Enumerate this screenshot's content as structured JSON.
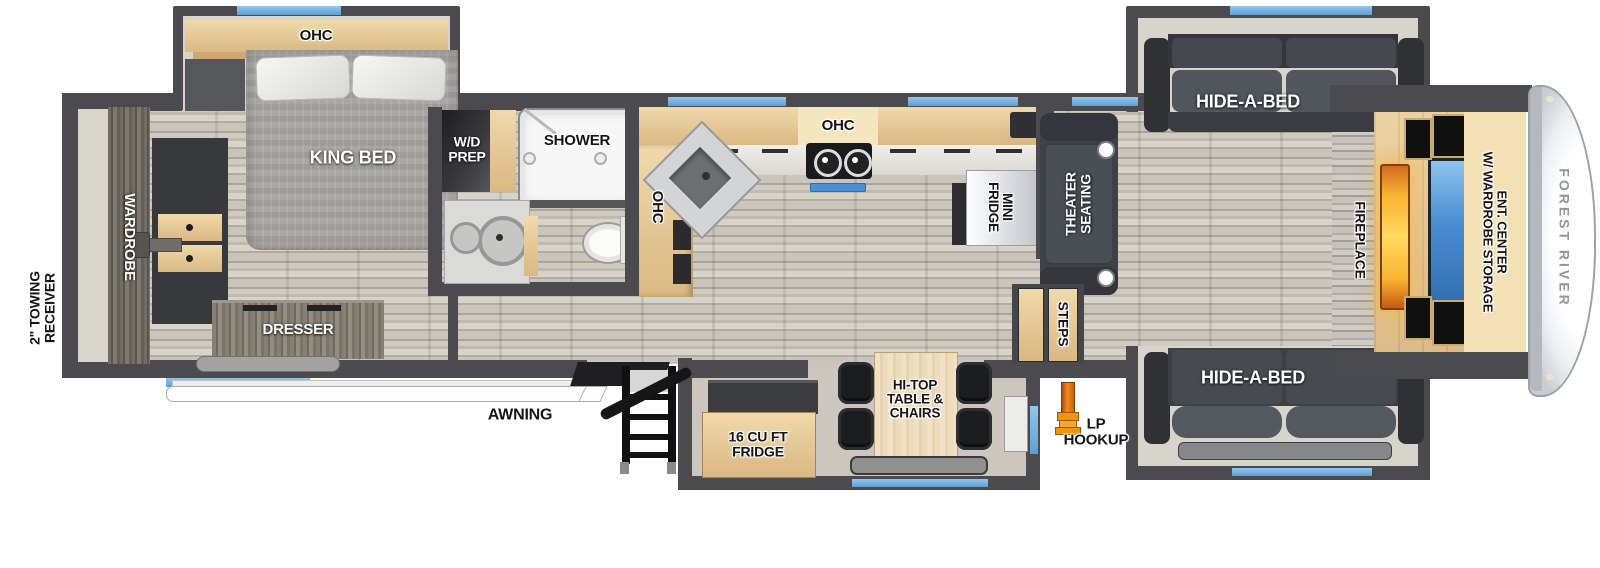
{
  "labels": {
    "towing_receiver": {
      "line1": "2\" TOWING",
      "line2": "RECEIVER"
    },
    "wardrobe": "WARDROBE",
    "bedroom_ohc": "OHC",
    "king_bed": "KING BED",
    "wd_prep": {
      "line1": "W/D",
      "line2": "PREP"
    },
    "shower": "SHOWER",
    "kitchen_ohc_side": "OHC",
    "kitchen_ohc_top": "OHC",
    "mini_fridge": {
      "line1": "MINI",
      "line2": "FRIDGE"
    },
    "theater_seating": {
      "line1": "THEATER",
      "line2": "SEATING"
    },
    "steps": "STEPS",
    "hide_a_bed_top": "HIDE-A-BED",
    "hide_a_bed_bottom": "HIDE-A-BED",
    "fireplace": "FIREPLACE",
    "ent_center": {
      "line1": "ENT. CENTER",
      "line2": "W/ WARDROBE STORAGE"
    },
    "brand": "FOREST RIVER",
    "dresser": "DRESSER",
    "awning": "AWNING",
    "exterior_fridge": {
      "line1": "16 CU FT",
      "line2": "FRIDGE"
    },
    "hi_top_table": {
      "line1": "HI-TOP",
      "line2": "TABLE &",
      "line3": "CHAIRS"
    },
    "lp_hookup": {
      "line1": "LP",
      "line2": "HOOKUP"
    }
  },
  "colors": {
    "wall": "#4b4b4f",
    "window_blue": "#6fabdd",
    "cabinet_wood": "#e3c693",
    "furniture_charcoal": "#3f4147",
    "fireplace_orange": "#f7a62b",
    "tv_blue": "#5aa0e0",
    "lp_orange": "#f0930f",
    "floor_plank": "#c8c4ba",
    "label_black": "#161616",
    "label_white": "#ffffff"
  }
}
